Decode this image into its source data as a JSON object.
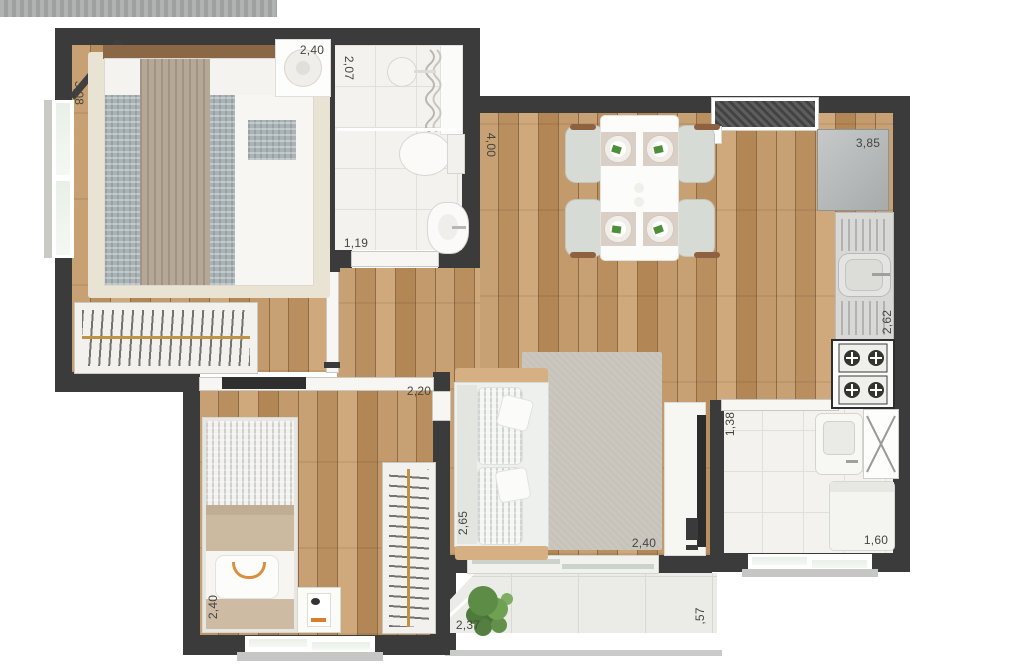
{
  "plan": {
    "dims": {
      "bedroom1_depth": "3,08",
      "bedroom1_width": "2,40",
      "bathroom_depth": "2,07",
      "bathroom_width": "1,19",
      "living_depth": "4,00",
      "living_width": "2,40",
      "kitchen_length": "3,85",
      "kitchen_counter": "2,62",
      "bedroom2_width": "2,20",
      "bedroom2_depth": "2,40",
      "sofa_wall": "2,65",
      "service_width": "1,38",
      "service_length": "1,60",
      "balcony_width": "2,37",
      "balcony_depth": ",57"
    },
    "colors": {
      "wall": "#3b3b3b",
      "wood_floor": "#c49e71",
      "tile_floor": "#f3f2ef",
      "balcony_floor": "#ebebe8",
      "glass": "#e9f0e8",
      "sofa_trim": "#d6b083",
      "label_text": "#454540",
      "plant": "#5d8c46",
      "rug_living": "#c7c3bb",
      "rug_bedroom": "#e9e3d3"
    }
  }
}
